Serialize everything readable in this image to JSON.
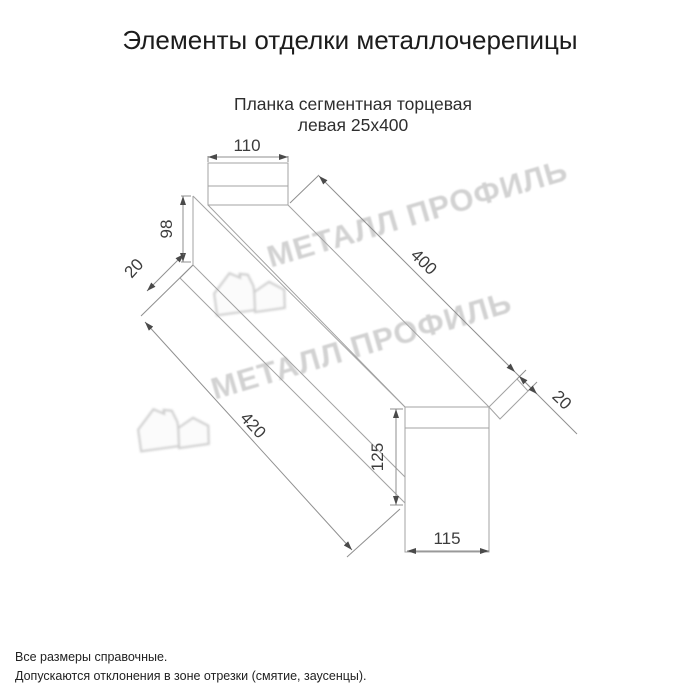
{
  "page": {
    "title": "Элементы отделки металлочерепицы"
  },
  "drawing": {
    "subtitle_line1": "Планка сегментная торцевая",
    "subtitle_line2": "левая 25х400",
    "dims": {
      "top_width": "110",
      "end_height": "98",
      "left_hem": "20",
      "length": "400",
      "right_hem": "20",
      "total_length": "420",
      "right_height": "125",
      "bottom_width": "115"
    }
  },
  "watermark": {
    "text": "МЕТАЛЛ ПРОФИЛЬ"
  },
  "footer": {
    "line1": "Все размеры справочные.",
    "line2": "Допускаются отклонения в зоне отрезки (смятие, заусенцы)."
  },
  "colors": {
    "part_line": "#a3a3a3",
    "dim_line": "#8f8f8f",
    "dim_text": "#3c3c3c",
    "watermark": "#d2d2d2"
  }
}
